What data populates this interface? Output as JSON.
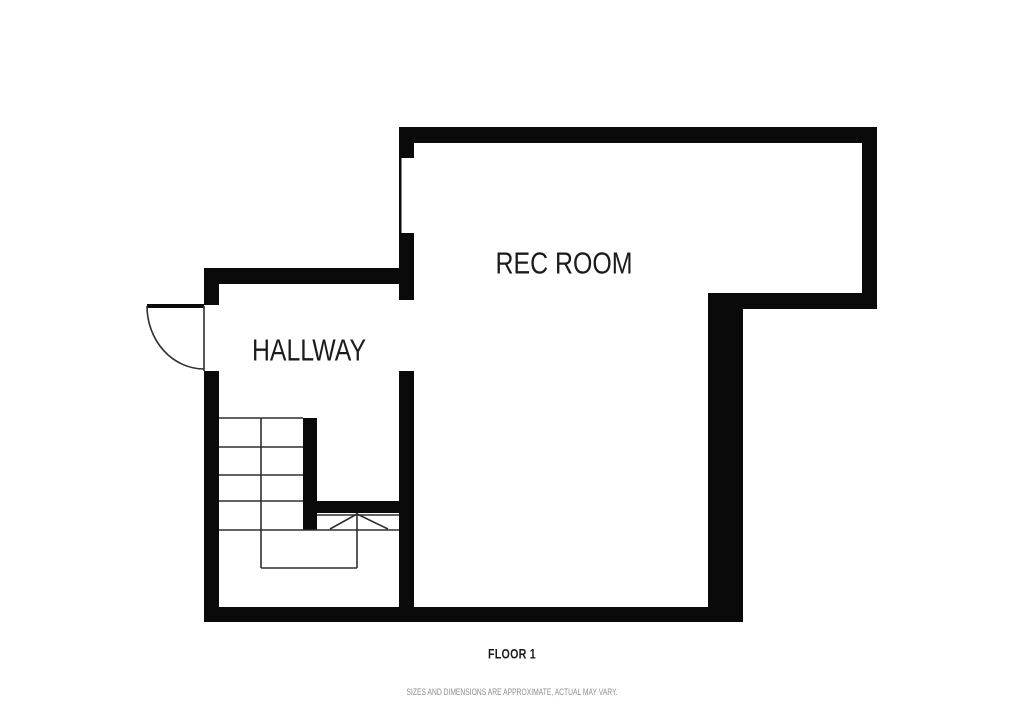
{
  "floor": {
    "label": "FLOOR 1"
  },
  "disclaimer": "SIZES AND DIMENSIONS ARE APPROXIMATE, ACTUAL MAY VARY.",
  "rooms": [
    {
      "name": "REC ROOM"
    },
    {
      "name": "HALLWAY"
    }
  ],
  "colors": {
    "background": "#ffffff",
    "wall": "#0a0a0a",
    "line": "#2f2f2f",
    "label_text": "#1b1b1b",
    "disclaimer_text": "#8e8e8e"
  }
}
